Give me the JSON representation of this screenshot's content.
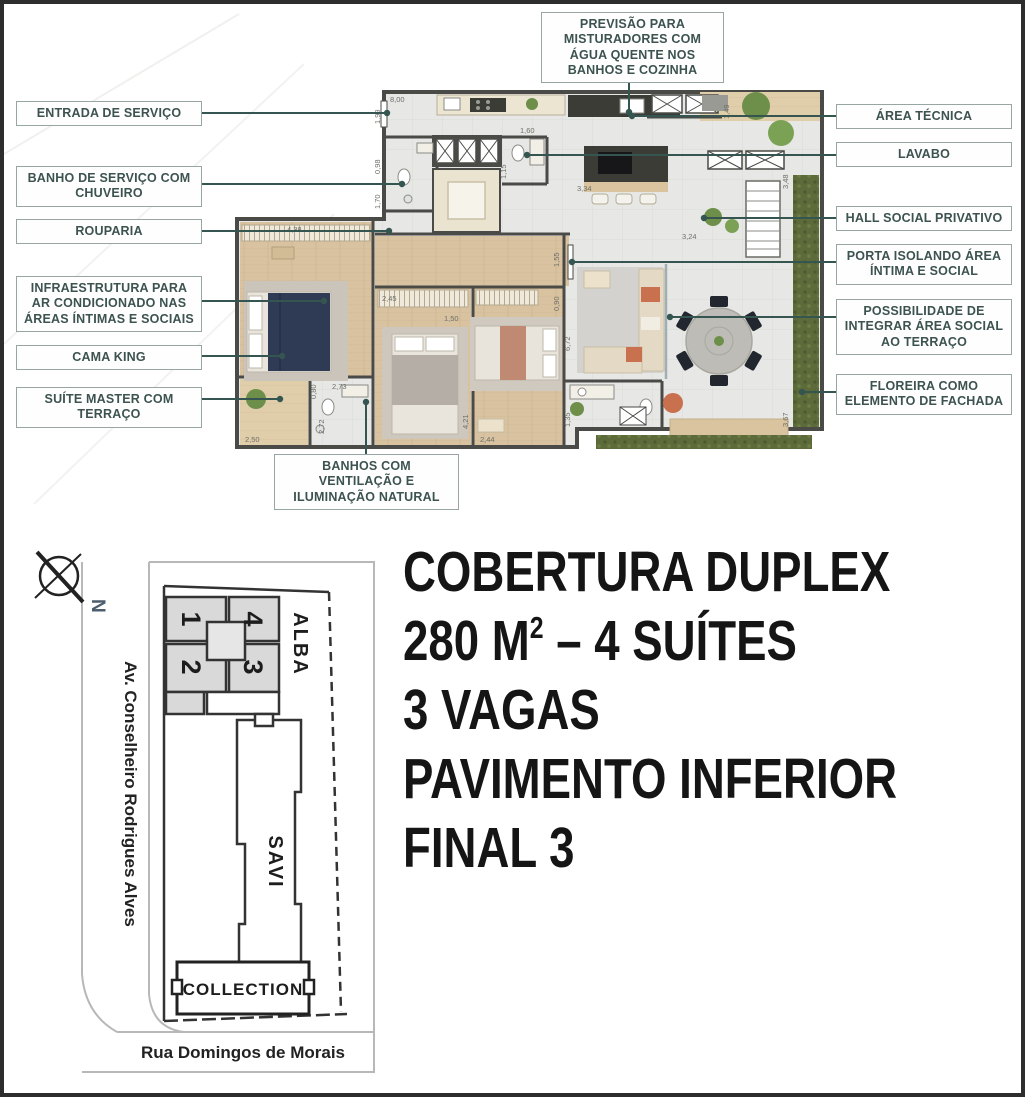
{
  "plan": {
    "callouts": {
      "top": "PREVISÃO PARA MISTURADORES COM ÁGUA QUENTE NOS BANHOS E COZINHA",
      "left": [
        "ENTRADA DE SERVIÇO",
        "BANHO DE SERVIÇO COM CHUVEIRO",
        "ROUPARIA",
        "INFRAESTRUTURA PARA AR CONDICIONADO NAS ÁREAS ÍNTIMAS E SOCIAIS",
        "CAMA KING",
        "SUÍTE MASTER COM TERRAÇO"
      ],
      "right": [
        "ÁREA TÉCNICA",
        "LAVABO",
        "HALL SOCIAL PRIVATIVO",
        "PORTA ISOLANDO ÁREA ÍNTIMA E SOCIAL",
        "POSSIBILIDADE DE INTEGRAR ÁREA SOCIAL AO TERRAÇO",
        "FLOREIRA COMO ELEMENTO DE FACHADA"
      ],
      "bottom": "BANHOS COM VENTILAÇÃO E ILUMINAÇÃO NATURAL"
    },
    "dimensions": [
      "8,00",
      "1,99",
      "0,98",
      "1,70",
      "4,38",
      "1,49",
      "1,60",
      "1,15",
      "3,34",
      "1,55",
      "0,90",
      "2,45",
      "1,50",
      "2,73",
      "0,80",
      "2,72",
      "2,50",
      "2,44",
      "4,21",
      "1,35",
      "6,72",
      "3,24",
      "3,48",
      "3,67"
    ],
    "colors": {
      "wall": "#4a4a46",
      "tile": "#e7e8e5",
      "wood": "#d8c2a0",
      "hedge": "#5c6b39",
      "leader": "#355550",
      "counter_dark": "#3c3c37",
      "sofa": "#e3d9c4",
      "accent_coral": "#c9704f",
      "bed_navy": "#2f3b55"
    }
  },
  "sitemap": {
    "compass_label": "N",
    "street_left": "Av. Conselheiro Rodrigues Alves",
    "street_bottom": "Rua Domingos de Morais",
    "buildings": {
      "alba": "ALBA",
      "savi": "SAVI",
      "collection": "COLLECTION",
      "units": [
        "1",
        "2",
        "3",
        "4"
      ]
    }
  },
  "description": {
    "line1": "COBERTURA DUPLEX",
    "line2_prefix": "280 M",
    "line2_sup": "2",
    "line2_suffix": " – 4 SUÍTES",
    "line3": "3 VAGAS",
    "line4": "PAVIMENTO INFERIOR",
    "line5": "FINAL 3"
  }
}
